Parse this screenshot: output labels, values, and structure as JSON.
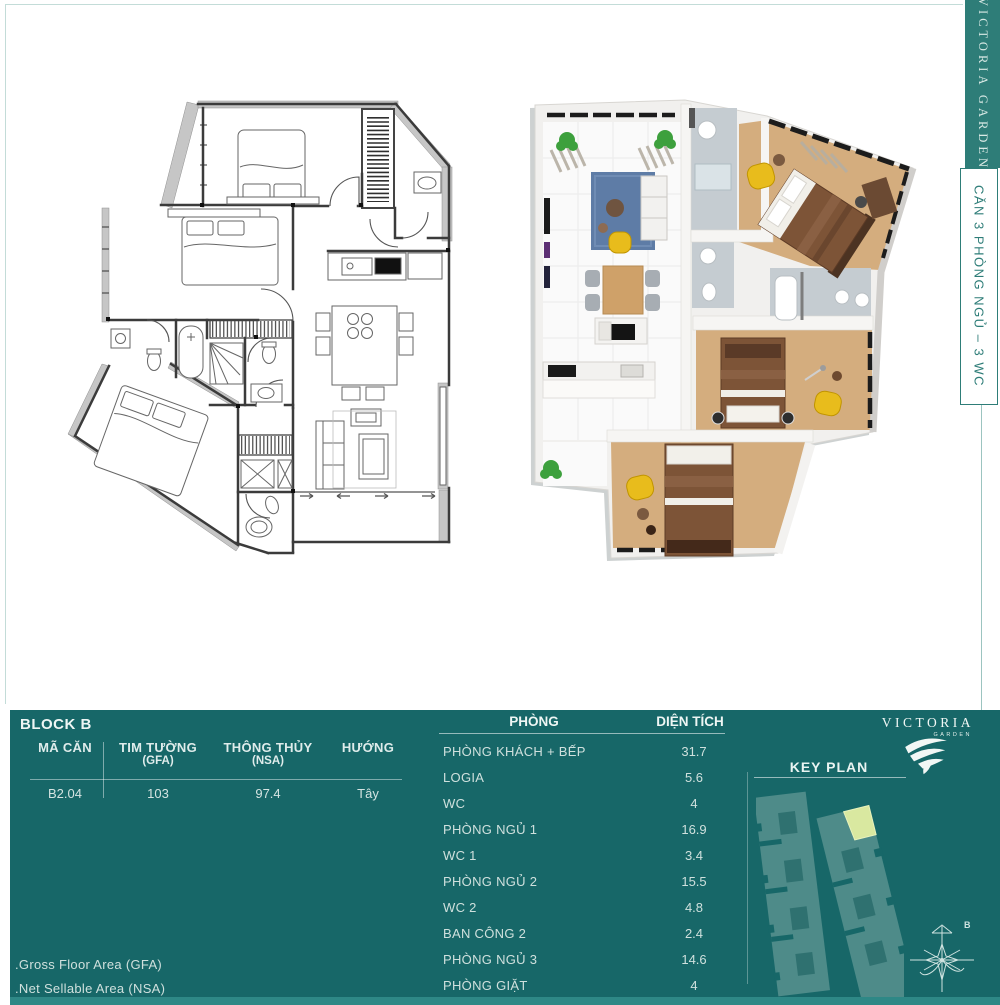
{
  "sidebar": {
    "brand": "VICTORIA GARDEN",
    "unit_type": "CĂN 3 PHÒNG NGỦ – 3 WC"
  },
  "logo": {
    "title": "VICTORIA",
    "subtitle": "GARDEN"
  },
  "block_info": {
    "title": "BLOCK B",
    "columns": [
      {
        "label": "MÃ CĂN",
        "sub": "",
        "value": "B2.04"
      },
      {
        "label": "TIM TƯỜNG",
        "sub": "(GFA)",
        "value": "103"
      },
      {
        "label": "THÔNG THỦY",
        "sub": "(NSA)",
        "value": "97.4"
      },
      {
        "label": "HƯỚNG",
        "sub": "",
        "value": "Tây"
      }
    ]
  },
  "rooms": {
    "col_room": "PHÒNG",
    "col_area": "DIỆN TÍCH",
    "rows": [
      {
        "name": "PHÒNG KHÁCH + BẾP",
        "area": "31.7"
      },
      {
        "name": "LOGIA",
        "area": "5.6"
      },
      {
        "name": "WC",
        "area": "4"
      },
      {
        "name": "PHÒNG NGỦ 1",
        "area": "16.9"
      },
      {
        "name": "WC 1",
        "area": "3.4"
      },
      {
        "name": "PHÒNG NGỦ 2",
        "area": "15.5"
      },
      {
        "name": "WC 2",
        "area": "4.8"
      },
      {
        "name": "BAN CÔNG 2",
        "area": "2.4"
      },
      {
        "name": "PHÒNG NGỦ 3",
        "area": "14.6"
      },
      {
        "name": "PHÒNG GIẶT",
        "area": "4"
      }
    ]
  },
  "keyplan": {
    "title": "KEY PLAN",
    "compass_label": "B"
  },
  "footnotes": {
    "gfa": ".Gross Floor Area (GFA)",
    "nsa": ".Net Sellable Area (NSA)"
  },
  "colors": {
    "panel_teal": "#176768",
    "sidebar_teal": "#2e7d78",
    "keyplan_building": "#4e8b89",
    "keyplan_highlight": "#d9e8a0",
    "wood_floor": "#d4ad7e",
    "accent_yellow": "#e8bc1c"
  }
}
